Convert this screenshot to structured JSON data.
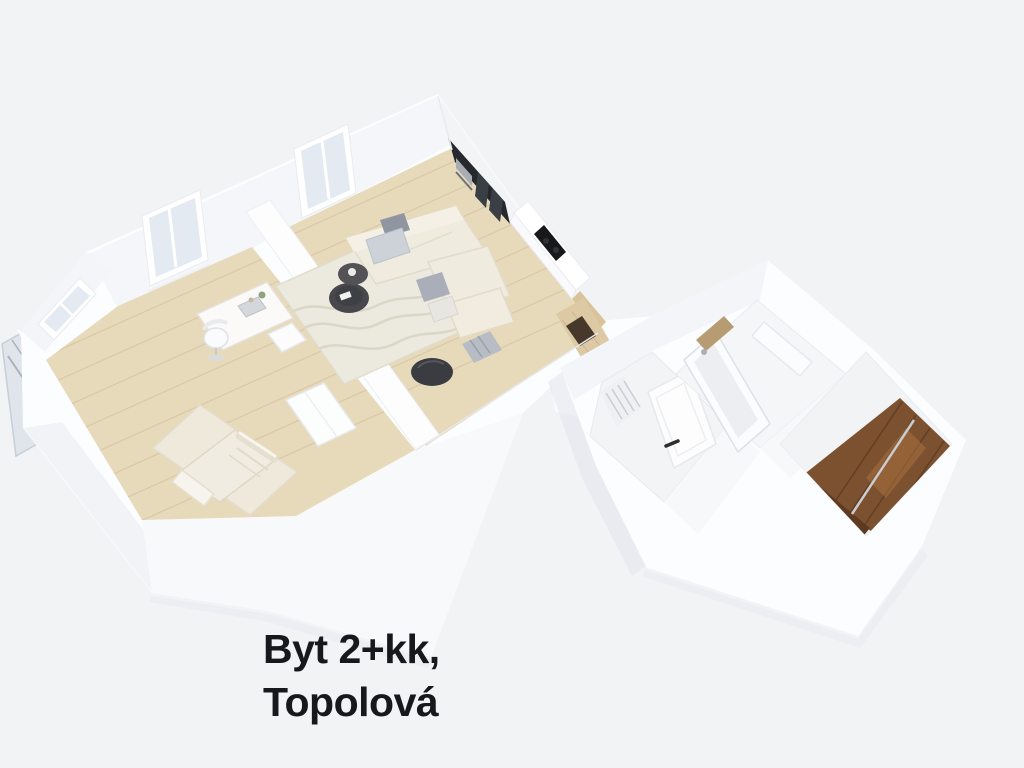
{
  "page": {
    "background": "#f2f3f5"
  },
  "caption": {
    "line1": "Byt 2+kk,",
    "line2": "Topolová",
    "color": "#17181c"
  },
  "colors": {
    "background": "#f2f3f5",
    "wall": "#fcfdfe",
    "wall_face": "#f5f6f9",
    "wall_face_dim": "#f2f3f6",
    "wall_shadow_band": "#e2e6ec",
    "floor_wood": "#e7dabb",
    "floor_wood_line": "#cfbb94",
    "rug_living": "#eceade",
    "rug_bedroom": "#efe9dc",
    "rug_pattern": "#d9d4c6",
    "bed": "#f1ece1",
    "sofa": "#f0ebdf",
    "sofa_backrest": "#f5f0e5",
    "cushion_dark": "#8f96a1",
    "cushion_gray": "#a9aeb9",
    "cushion_light": "#cdd2d9",
    "table_dark": "#48484c",
    "armchair_dark": "#3a3c41",
    "kitchen_dark": "#26282d",
    "kitchen_glass": "#3a3f46",
    "steel": "#a7adb3",
    "counter": "#fafafc",
    "counter_wood": "#d8c39b",
    "cooktop": "#17181a",
    "corridor_wood": "#ddcaa4",
    "doormat": "#46392b",
    "door": "#fdfdfe",
    "handle": "#2e2e33",
    "radiator_line": "#c9cdd4",
    "tub": "#fbfcfd",
    "tub_inner": "#eceef2",
    "wood_shelf": "#b79c73",
    "entry_wood": "#7c5130",
    "entry_wood_dark": "#5e3b20",
    "entry_wood_light": "#a9713f",
    "entry_wood_line": "#5a381e",
    "silver_line": "#c9ccd1",
    "glass": "#e3eaf1",
    "glass_deep": "#dde4ea",
    "railing_metal": "#aab3bb",
    "furniture_white": "#fbfafa",
    "shadow": "#e8eaee"
  },
  "floorplan": {
    "rooms": [
      {
        "name": "bedroom",
        "furnishings": [
          "double-bed",
          "rug",
          "desk",
          "office-chair",
          "side-shelf",
          "wardrobe",
          "window",
          "corner-window-with-glass-railing"
        ]
      },
      {
        "name": "living-room-with-kitchenette",
        "furnishings": [
          "corner-sofa",
          "cushions",
          "round-coffee-tables",
          "area-rug",
          "tall-kitchen-unit-with-oven",
          "glass-front-cabinets",
          "counter-with-cooktop",
          "window",
          "dark-armchair",
          "gray-pouf"
        ]
      },
      {
        "name": "hallway",
        "furnishings": [
          "entrance-door",
          "radiator"
        ]
      },
      {
        "name": "bathroom",
        "furnishings": [
          "bathtub",
          "wooden-shelf",
          "washbasin-counter"
        ]
      },
      {
        "name": "entry-closet",
        "furnishings": [
          "built-in-walnut-wardrobe",
          "dark-wood-floor"
        ]
      }
    ]
  }
}
